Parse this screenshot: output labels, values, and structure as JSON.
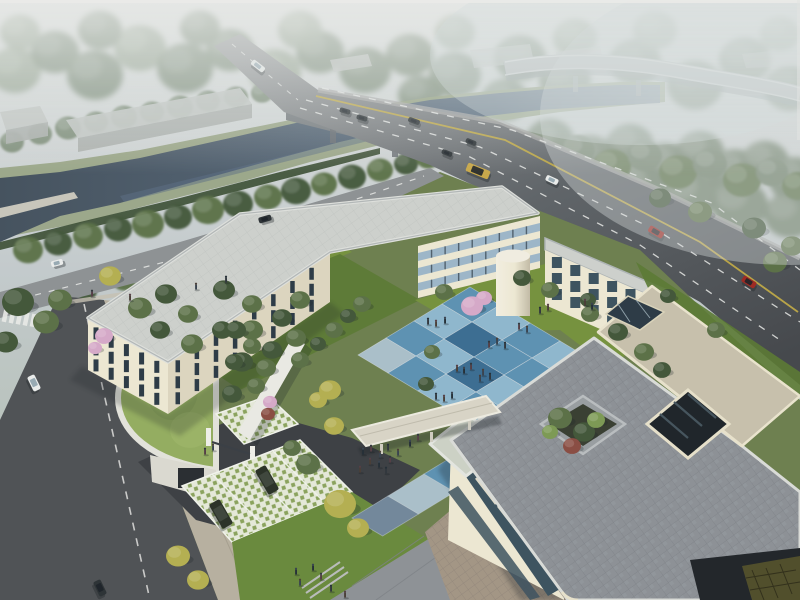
{
  "meta": {
    "kind": "architectural-aerial-rendering",
    "description": "Bird's-eye rendering of a cream low-rise campus building with blue checkerboard courtyard, green-roof gatehouse, river with bridge and elevated highway in misty background"
  },
  "scene": {
    "elements": [
      "sky-mist",
      "distant-forest",
      "river",
      "river-bridge",
      "elevated-highway",
      "main-road",
      "tree-lined-avenue",
      "side-street",
      "crosswalk",
      "campus-garden",
      "green-roof-gatehouse",
      "entrance-gate",
      "grass-paver-parking",
      "parked-suv",
      "lawn",
      "pedestrian-plaza",
      "blue-courtyard-plaza",
      "main-building",
      "stair-tower",
      "covered-walkway",
      "right-building",
      "roof-terrace",
      "roof-planter",
      "glass-light-well",
      "pedestrians",
      "vehicles"
    ]
  },
  "palette": {
    "skyTop": "#e0e2e0",
    "sky": "#c3cacc",
    "fogGreen": "#aebbac",
    "fogWhite": "#d6dcdc",
    "treeFogLight": "#9aa795",
    "treeFogDark": "#7f8f7b",
    "treeFog": "#6f8069",
    "treeDark": "#44583b",
    "treeMid": "#5c7148",
    "treeLight": "#7d9a55",
    "treeYellow": "#b4af52",
    "treeBlossom": "#d5a9c8",
    "treeRed": "#8a4e44",
    "lawn": "#76923f",
    "lawnDark": "#5c7a35",
    "grassRoof": "#94ad61",
    "hedge": "#3c4f34",
    "bankGrass": "#8c9a72",
    "water": "#46535f",
    "waterLight": "#5f7183",
    "roadFar": "#97999a",
    "road": "#606569",
    "roadDark": "#46494d",
    "roadLine": "#e8e9e6",
    "roadYellow": "#c4ad47",
    "avenue": "#8e9294",
    "street": "#505356",
    "sidewalk": "#b7b0a0",
    "drive": "#3e4145",
    "wallCream": "#ece7d2",
    "wallCreamShade": "#dcd5bf",
    "wallDark": "#c2bba6",
    "roofLight": "#cdd0cc",
    "roofRim": "#9ba1a2",
    "roofGray": "#8d9196",
    "parapet": "#e7e1cb",
    "terraceBeige": "#c7c0ac",
    "terraceTan": "#a39685",
    "sageRoof": "#ccd1c5",
    "glassDark": "#2e3c47",
    "glassBlue": "#9db6c8",
    "glassTeal": "#3e5460",
    "plazaLight": "#8fb7cd",
    "plazaMid": "#5e92b2",
    "plazaDark": "#3d6e92",
    "plazaSlate": "#73889b",
    "plazaPale": "#aabfc9",
    "latticeBase": "#e4e8d8",
    "latticeGreen": "#8ba35e",
    "carDark": "#2e3437",
    "carWhite": "#e9ebea",
    "carRed": "#9e2b24",
    "carYellow": "#c8a84b",
    "suvDark": "#2c3329",
    "people": "#3a3f45",
    "shadow": "#1c2226",
    "oliveGlass": "#514f2c",
    "wellDark": "#20262b",
    "warehouse": "#c3c7c4",
    "warehouseFace": "#adb1ae",
    "bridgeSide": "#787d80",
    "highway": "#b7bbbc"
  },
  "counts": {
    "pedestrians": 45,
    "vehicles": 16,
    "parked_suvs": 2
  }
}
